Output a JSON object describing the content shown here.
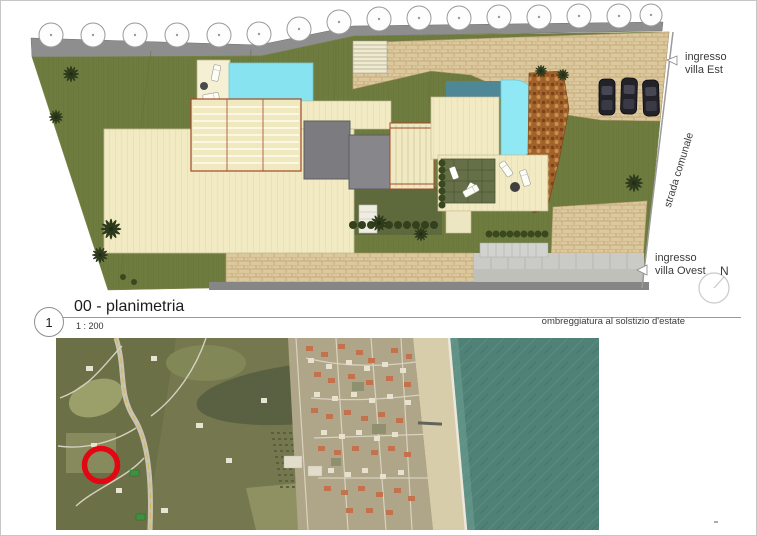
{
  "titleblock": {
    "number": "1",
    "title": "00 - planimetria",
    "scale": "1 : 200",
    "note": "ombreggiatura al solstizio d'estate"
  },
  "plan": {
    "labels": {
      "entrance_east": "ingresso\nvilla Est",
      "road": "strada comunale",
      "entrance_west": "ingresso\nvilla Ovest",
      "north": "N"
    },
    "colors": {
      "lawn": "#6F7C3F",
      "paving": "#DBC89D",
      "pool": "#87E3F0",
      "building": "#F1EAC3",
      "roof": "#7C7C80",
      "road_band": "#8E8E8E"
    }
  },
  "map": {
    "marker_icon": "red-circle-marker",
    "marker_color": "#E30613",
    "sea_color": "#4F8177",
    "beach_color": "#D7CDAB"
  }
}
